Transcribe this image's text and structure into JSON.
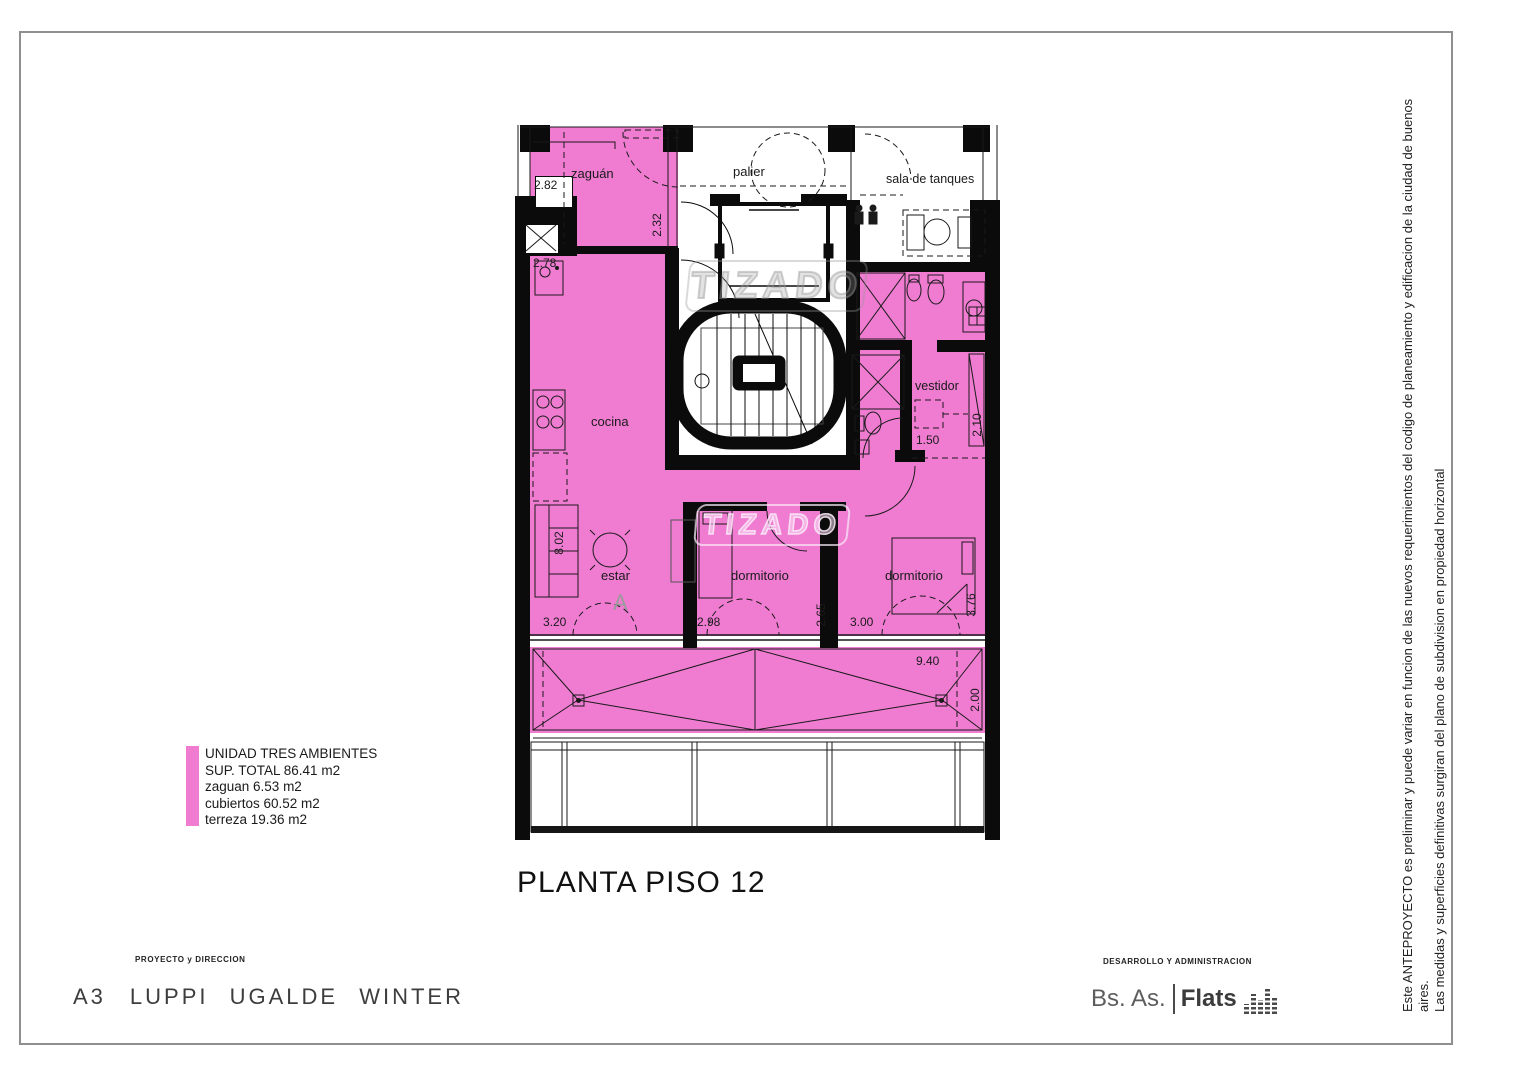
{
  "page": {
    "title": "PLANTA PISO 12",
    "legend": {
      "color": "#F07CD2",
      "lines": [
        "UNIDAD TRES AMBIENTES",
        "SUP. TOTAL 86.41 m2",
        "zaguan 6.53 m2",
        "cubiertos 60.52 m2",
        "terreza 19.36 m2"
      ]
    },
    "footer_left": {
      "heading": "PROYECTO y DIRECCION",
      "name_prefix": "A3",
      "name": "LUPPI UGALDE WINTER"
    },
    "footer_right": {
      "heading": "DESARROLLO Y ADMINISTRACION",
      "brand_left": "Bs. As.",
      "brand_right": "Flats",
      "brand_icon": "equalizer-bars-icon"
    },
    "disclaimer": {
      "line1": "Este ANTEPROYECTO es preliminar y puede variar en funcion de las nuevos requerimientos del codigo de planeamiento y edificacion de la ciudad de buenos aires.",
      "line2": "Las medidas y superficies definitivas surgiran del plano de subdivision en propiedad horizontal"
    }
  },
  "plan": {
    "watermark": "TIZADO",
    "section_marker": "A",
    "unit_fill": "#F07CD2",
    "rooms": {
      "zaguan": "zaguán",
      "palier": "palier",
      "tanques": "sala de tanques",
      "cocina": "cocina",
      "vestidor": "vestidor",
      "estar": "estar",
      "dorm1": "dormitorio",
      "dorm2": "dormitorio"
    },
    "dims": {
      "d282": "2.82",
      "d278": "2.78",
      "d232": "2.32",
      "d802": "8.02",
      "d320": "3.20",
      "d298": "2.98",
      "d265": "2.65",
      "d300": "3.00",
      "d376": "3.76",
      "d150": "1.50",
      "d210": "2.10",
      "d940": "9.40",
      "d200": "2.00"
    }
  }
}
